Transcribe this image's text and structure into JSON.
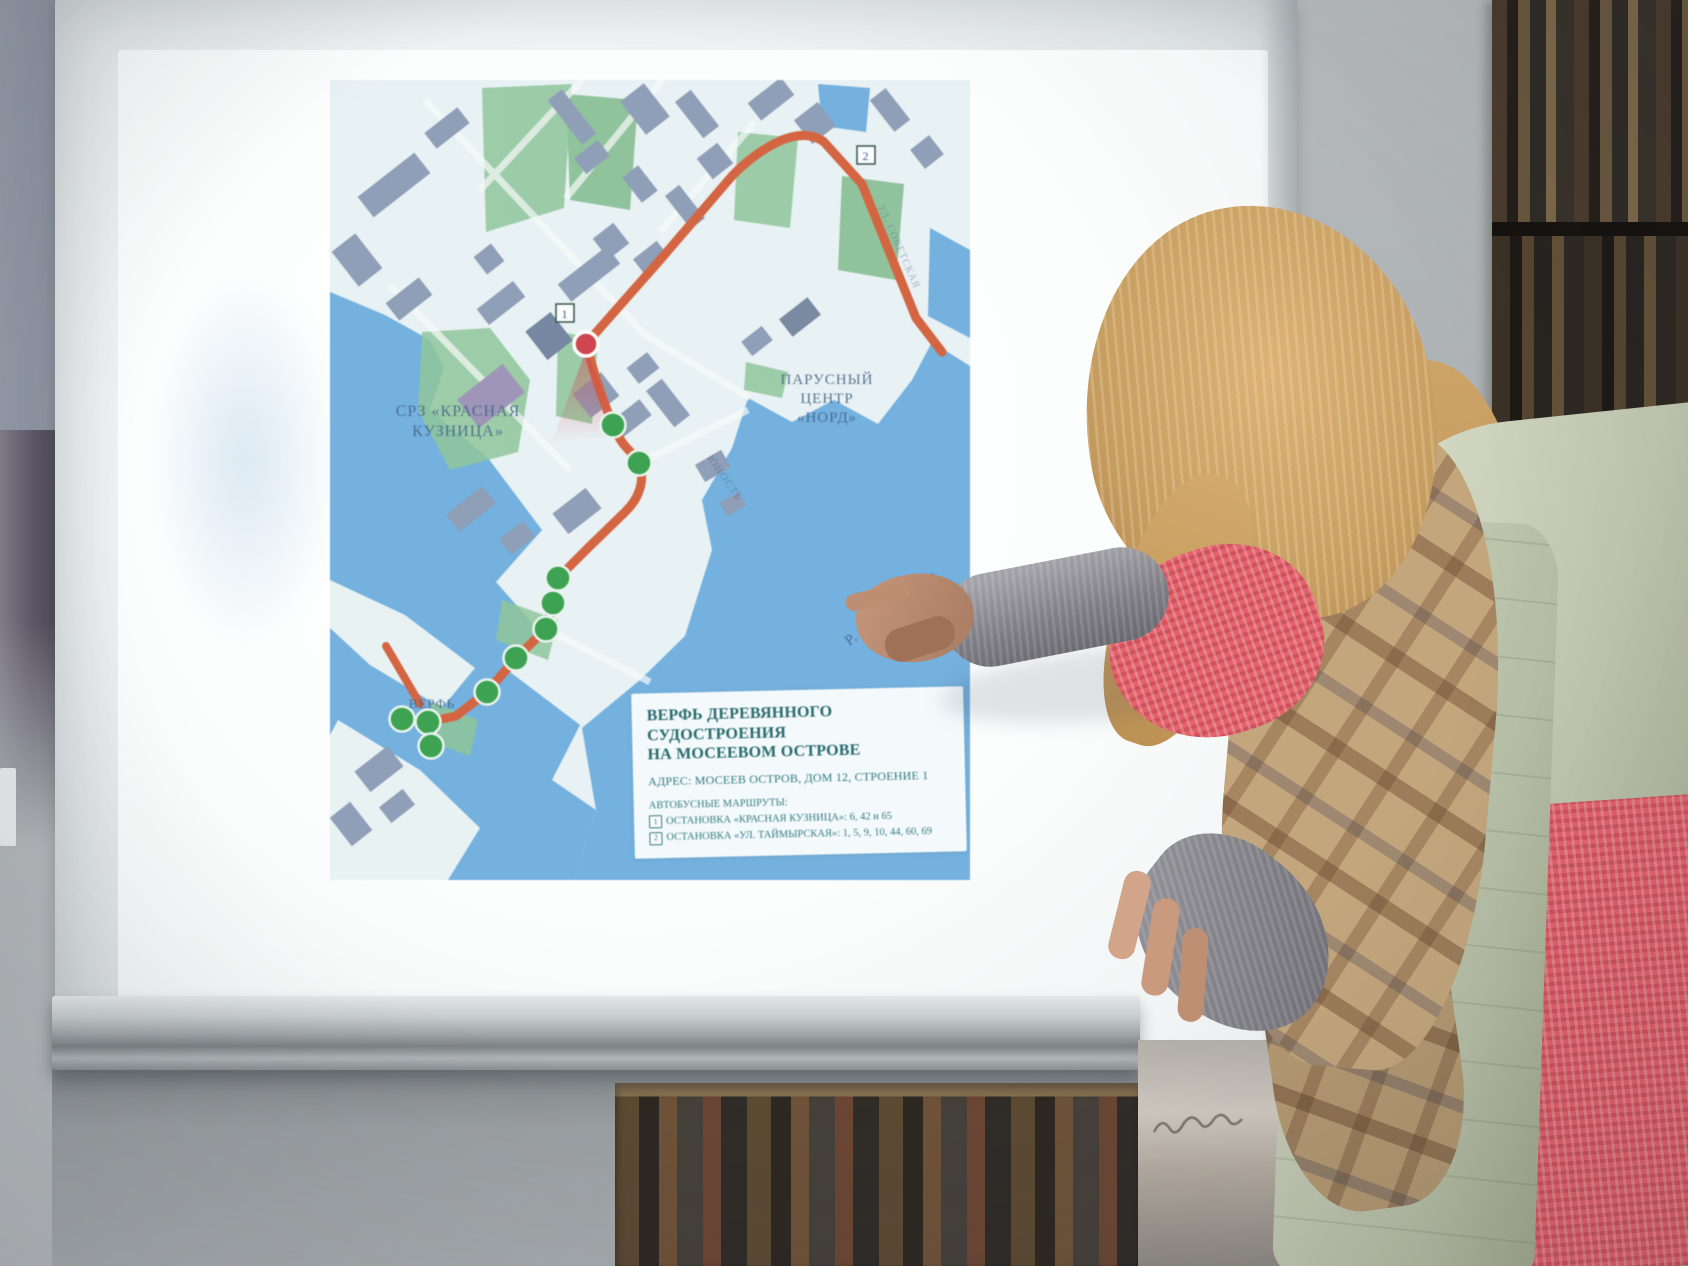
{
  "map": {
    "marker1": "1",
    "marker2": "2",
    "labels": {
      "shipyard_line1": "СРЗ «КРАСНАЯ",
      "shipyard_line2": "КУЗНИЦА»",
      "sailing_center_line1": "ПАРУСНЫЙ",
      "sailing_center_line2": "ЦЕНТР",
      "sailing_center_line3": "«НОРД»",
      "wharf": "ВЕРФЬ",
      "stadium": "ЮНОСТЬ",
      "river": "Р. КУЗНЕЧИХА",
      "street": "УЛ. СОВЕТСКАЯ"
    },
    "colors": {
      "water": "#6fafdf",
      "land": "#e9f2f4",
      "park": "#8cc598",
      "building": "#8c9cb6",
      "route": "#d4603b",
      "bus_stop": "#36a14c",
      "origin_marker": "#cf3f48"
    }
  },
  "infobox": {
    "title_line1": "ВЕРФЬ ДЕРЕВЯННОГО СУДОСТРОЕНИЯ",
    "title_line2": "НА МОСЕЕВОМ ОСТРОВЕ",
    "address": "АДРЕС: МОСЕЕВ ОСТРОВ, ДОМ 12, СТРОЕНИЕ 1",
    "routes_heading": "АВТОБУСНЫЕ МАРШРУТЫ:",
    "stop1_marker": "1",
    "stop1_text": "ОСТАНОВКА «КРАСНАЯ КУЗНИЦА»: 6, 42 и 65",
    "stop2_marker": "2",
    "stop2_text": "ОСТАНОВКА «УЛ. ТАЙМЫРСКАЯ»: 1, 5, 9, 10, 44, 60, 69"
  }
}
